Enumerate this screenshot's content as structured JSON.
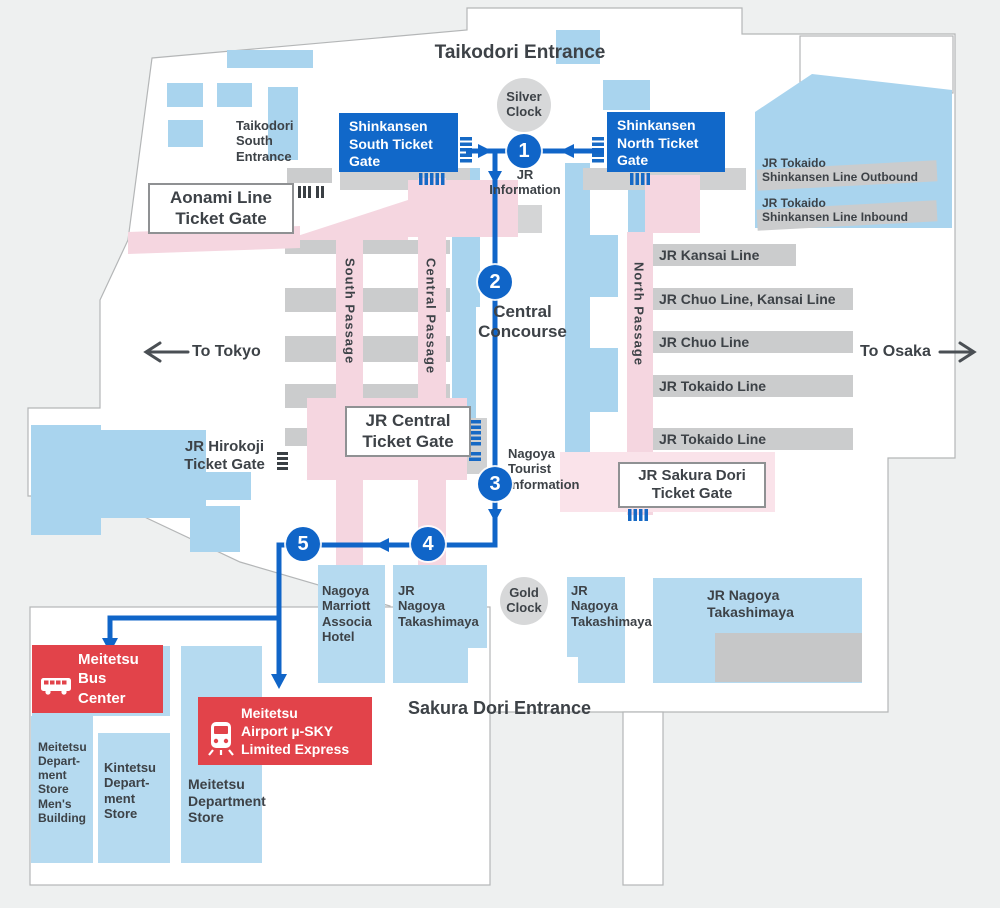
{
  "colors": {
    "background": "#eef0f0",
    "station_white": "#ffffff",
    "map_blue_light": "#a9d4ee",
    "building_blue": "#b5daf0",
    "passage_pink": "#f5d6e0",
    "pale_pink": "#fae3ea",
    "platform_gray": "#cbcccd",
    "gate_blue": "#1168c9",
    "route_blue": "#1065c8",
    "alert_red": "#e2434a",
    "text_dark": "#3d4247"
  },
  "labels": {
    "taikodori_entrance": "Taikodori Entrance",
    "taikodori_south_entrance": "Taikodori\nSouth\nEntrance",
    "sakura_dori_entrance": "Sakura Dori Entrance",
    "silver_clock": "Silver\nClock",
    "gold_clock": "Gold\nClock",
    "jr_information": "JR\nInformation",
    "central_concourse": "Central\nConcourse",
    "nagoya_tourist_information": "Nagoya\nTourist\nInformation",
    "to_tokyo": "To Tokyo",
    "to_osaka": "To Osaka"
  },
  "gates": {
    "shinkansen_south": "Shinkansen\nSouth Ticket\nGate",
    "shinkansen_north": "Shinkansen\nNorth Ticket\nGate",
    "aonami": "Aonami Line\nTicket Gate",
    "jr_central": "JR Central\nTicket Gate",
    "jr_hirokoji": "JR Hirokoji\nTicket Gate",
    "jr_sakura_dori": "JR Sakura Dori\nTicket Gate"
  },
  "rail_lines": {
    "shinkansen_outbound": "JR Tokaido\nShinkansen Line Outbound",
    "shinkansen_inbound": "JR Tokaido\nShinkansen Line Inbound",
    "kansai": "JR Kansai Line",
    "chuo_kansai": "JR Chuo Line, Kansai Line",
    "chuo": "JR Chuo Line",
    "tokaido_1": "JR Tokaido Line",
    "tokaido_2": "JR Tokaido Line"
  },
  "passages": {
    "south": "South Passage",
    "central": "Central Passage",
    "north": "North Passage"
  },
  "route_stops": [
    "1",
    "2",
    "3",
    "4",
    "5"
  ],
  "buildings": {
    "marriott": "Nagoya\nMarriott\nAssocia\nHotel",
    "takashimaya_1": "JR\nNagoya\nTakashimaya",
    "takashimaya_2": "JR\nNagoya\nTakashimaya",
    "takashimaya_3": "JR Nagoya\nTakashimaya",
    "meitetsu_dept_mens": "Meitetsu\nDepart-\nment\nStore\nMen's\nBuilding",
    "kintetsu_dept": "Kintetsu\nDepart-\nment\nStore",
    "meitetsu_dept": "Meitetsu\nDepartment\nStore"
  },
  "transport": {
    "meitetsu_bus": "Meitetsu\nBus\nCenter",
    "meitetsu_airport": "Meitetsu\nAirport µ-SKY\nLimited Express"
  }
}
